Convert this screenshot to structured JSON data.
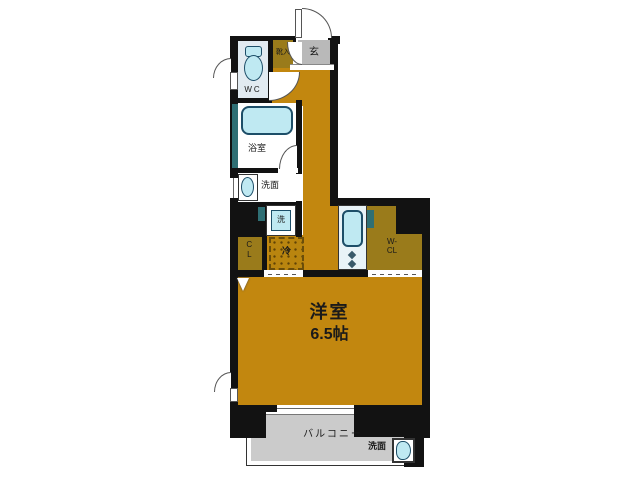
{
  "rooms": {
    "wc": {
      "label": "WC"
    },
    "shoe_cabinet": {
      "label": "靴入"
    },
    "entrance": {
      "label": "玄"
    },
    "bathroom": {
      "label": "浴室"
    },
    "washroom": {
      "label": "洗面"
    },
    "washer": {
      "label": "洗"
    },
    "closet": {
      "label": "CL"
    },
    "refrigerator": {
      "label": "冷"
    },
    "walk_in_closet": {
      "line1": "W-",
      "line2": "CL"
    },
    "main_room": {
      "name": "洋室",
      "size": "6.5帖"
    },
    "balcony": {
      "label": "バルコニー"
    },
    "outdoor_basin": {
      "label": "洗面"
    }
  },
  "colors": {
    "floor": "#c2870f",
    "closet_floor": "#9a7b1b",
    "entrance_floor": "#b9b9b9",
    "balcony_floor": "#cbcbcb",
    "wall": "#121212",
    "fixture_fill": "#bfe9f2",
    "fixture_border": "#1d4e68",
    "wc_floor": "#e2ebf1",
    "kitchen_floor": "#e9f3f7",
    "pipe_space": "#2f6f74"
  }
}
